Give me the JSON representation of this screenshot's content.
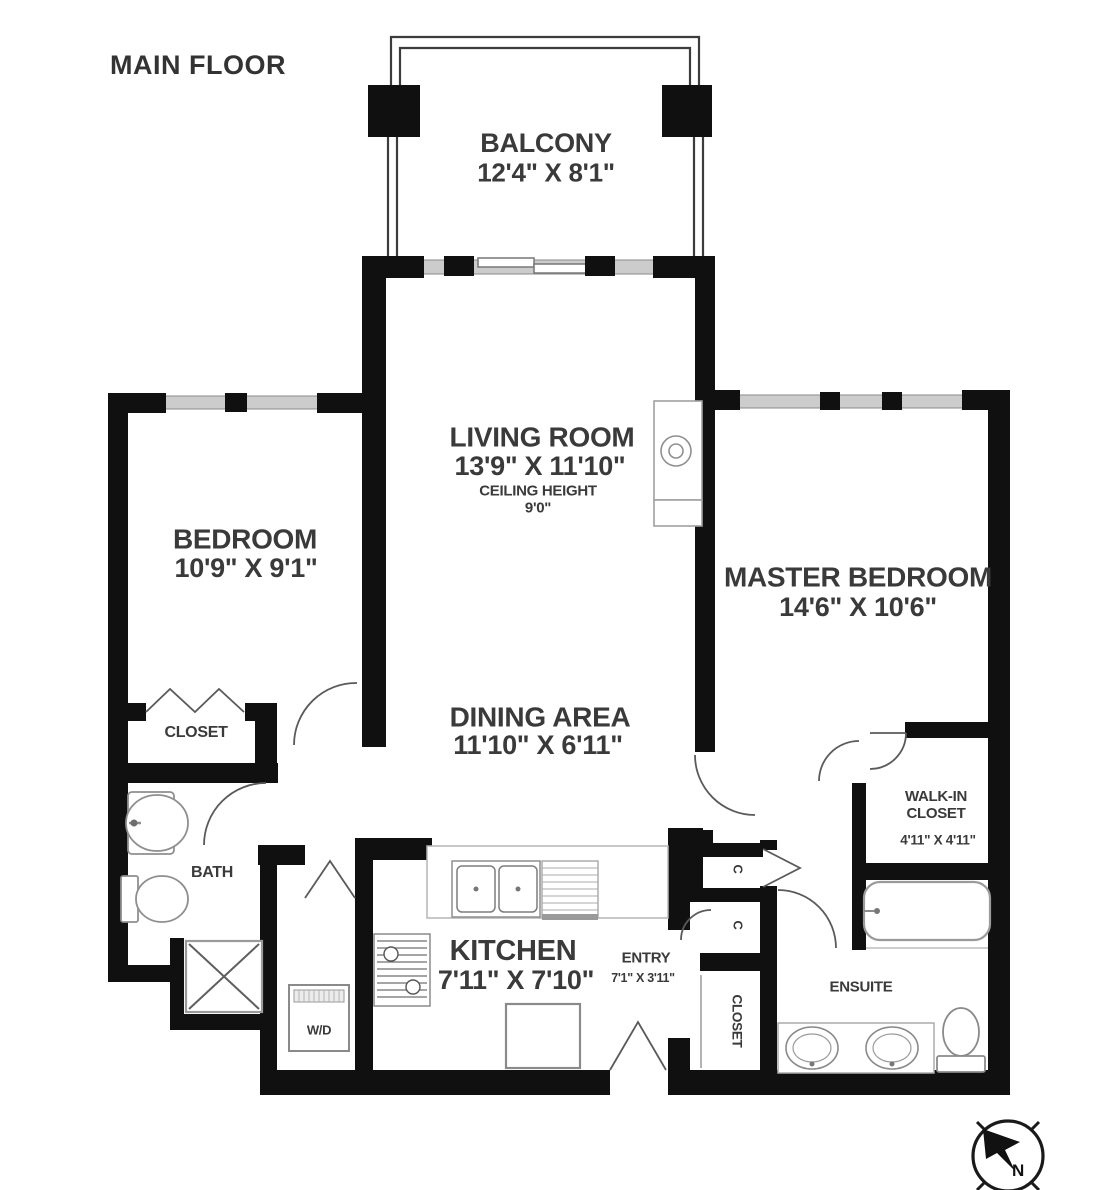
{
  "title": "MAIN FLOOR",
  "compass": {
    "north": "N"
  },
  "rooms": {
    "balcony": {
      "name": "BALCONY",
      "dims": "12'4\" X 8'1\""
    },
    "living": {
      "name": "LIVING ROOM",
      "dims": "13'9\" X 11'10\"",
      "note_line1": "CEILING HEIGHT",
      "note_line2": "9'0\""
    },
    "bedroom": {
      "name": "BEDROOM",
      "dims": "10'9\" X 9'1\""
    },
    "master": {
      "name": "MASTER BEDROOM",
      "dims": "14'6\" X 10'6\""
    },
    "dining": {
      "name": "DINING AREA",
      "dims": "11'10\" X 6'11\""
    },
    "kitchen": {
      "name": "KITCHEN",
      "dims": "7'11\" X 7'10\""
    },
    "entry": {
      "name": "ENTRY",
      "dims": "7'1\" X 3'11\""
    },
    "walkin": {
      "name": "WALK-IN CLOSET",
      "dims": "4'11\" X 4'11\""
    },
    "closet": {
      "name": "CLOSET"
    },
    "bath": {
      "name": "BATH"
    },
    "ensuite": {
      "name": "ENSUITE"
    },
    "entry_closet": {
      "name": "CLOSET"
    },
    "laundry": {
      "name": "W/D"
    },
    "cabinet1": {
      "name": "C"
    },
    "cabinet2": {
      "name": "C"
    }
  },
  "colors": {
    "wall": "#101010",
    "window": "#cccccc",
    "fixture": "#8f8f8f",
    "text": "#3a3a3a"
  }
}
